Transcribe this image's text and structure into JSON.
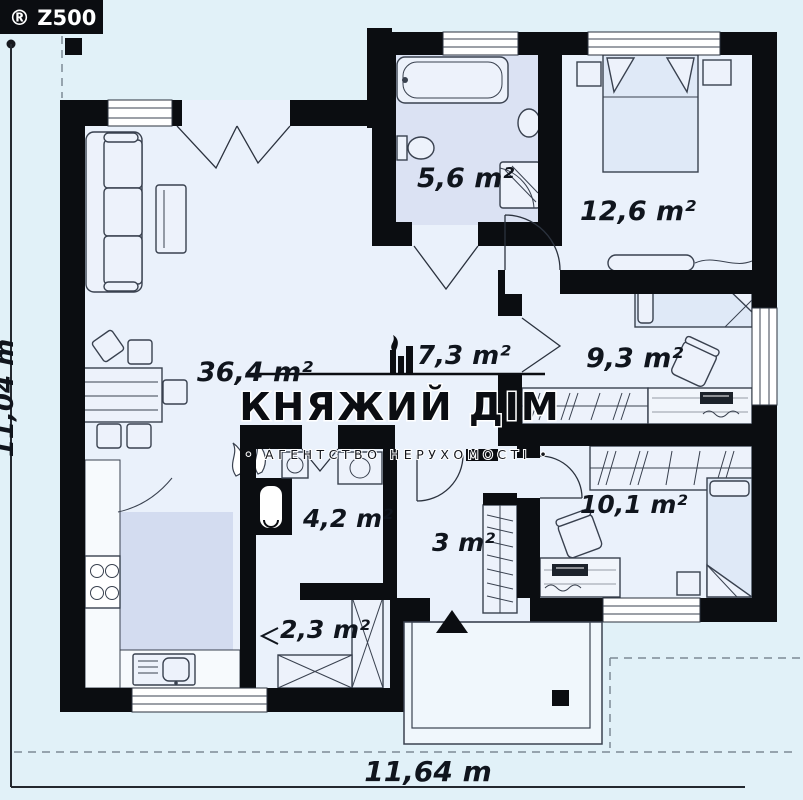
{
  "brand": {
    "logo_text": "® Z500"
  },
  "watermark": {
    "icon": "castle-icon",
    "title": "КНЯЖИЙ ДІМ",
    "subtitle": "• АГЕНТСТВО НЕРУХОМОСТІ •"
  },
  "rooms": {
    "living": "36,4 m²",
    "hall": "7,3 m²",
    "bathroom": "5,6 m²",
    "bedroom1": "12,6 m²",
    "bedroom2": "9,3 m²",
    "bedroom3": "10,1 m²",
    "utility": "4,2 m²",
    "entry": "3 m²",
    "storage": "2,3 m²"
  },
  "dimensions": {
    "overall_width": "11,64 m",
    "overall_depth_partial": "11,04 m"
  },
  "colors": {
    "wall": "#0b0d11",
    "background": "#e1f1f8",
    "room_floor": "#eaf1fb",
    "wet_room_floor": "#dbe2f3",
    "kitchen_floor": "#d3dcf0",
    "furniture_stroke": "#39414f",
    "label_text": "#10151d"
  }
}
